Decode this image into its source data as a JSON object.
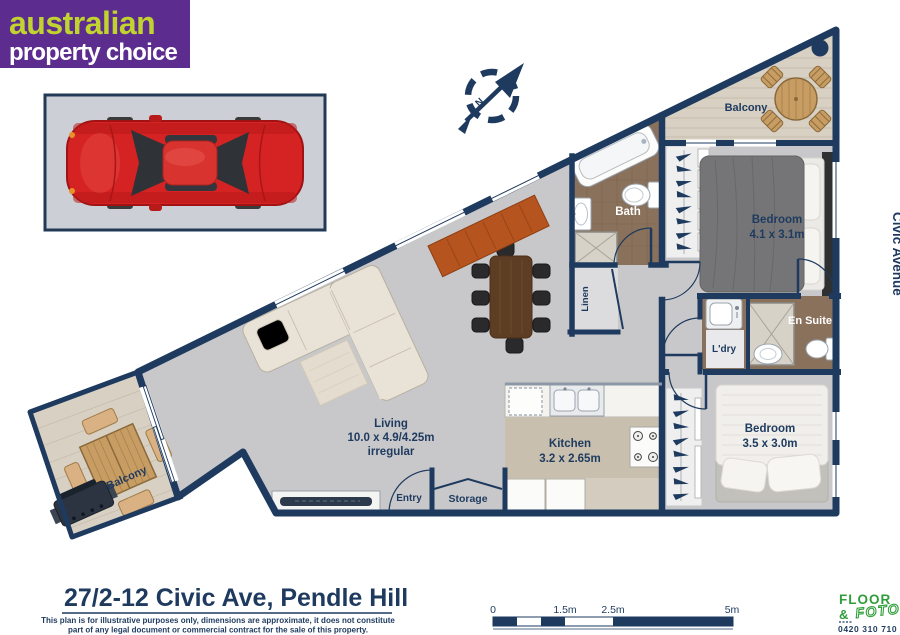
{
  "brand": {
    "name_line1": "australian",
    "name_line2": "property choice"
  },
  "compass": {
    "north_label": "N"
  },
  "street_label": "Civic Avenue",
  "rooms": {
    "balcony_top": {
      "label": "Balcony"
    },
    "bedroom_main": {
      "label": "Bedroom",
      "dimensions": "4.1 x 3.1m"
    },
    "bath": {
      "label": "Bath"
    },
    "linen": {
      "label": "Linen"
    },
    "laundry": {
      "label": "L'dry"
    },
    "ensuite": {
      "label": "En Suite"
    },
    "bedroom_second": {
      "label": "Bedroom",
      "dimensions": "3.5 x 3.0m"
    },
    "kitchen": {
      "label": "Kitchen",
      "dimensions": "3.2 x 2.65m"
    },
    "living": {
      "label": "Living",
      "dimensions": "10.0 x 4.9/4.25m",
      "note": "irregular"
    },
    "entry": {
      "label": "Entry"
    },
    "storage": {
      "label": "Storage"
    },
    "balcony_bottom": {
      "label": "Balcony"
    }
  },
  "footer": {
    "address": "27/2-12 Civic Ave, Pendle Hill",
    "disclaimer_line1": "This plan is for illustrative purposes only, dimensions are approximate, it does not constitute",
    "disclaimer_line2": "part of any legal document or commercial contract for the sale of this property.",
    "scale_ticks": [
      "0",
      "1.5m",
      "2.5m",
      "5m"
    ],
    "vendor": {
      "word1": "FLOOR",
      "amp": "&",
      "word2": "FOTO",
      "phone": "0420 310 710"
    }
  },
  "colors": {
    "wall": "#1e3a5f",
    "brand_purple": "#5c2d8f",
    "brand_lime": "#c1d32f",
    "vendor_green": "#2f9e3a",
    "floor_grey": "#c8c8ca",
    "balcony_floor": "#d8d0c3",
    "tile_brown": "#8a715b"
  }
}
